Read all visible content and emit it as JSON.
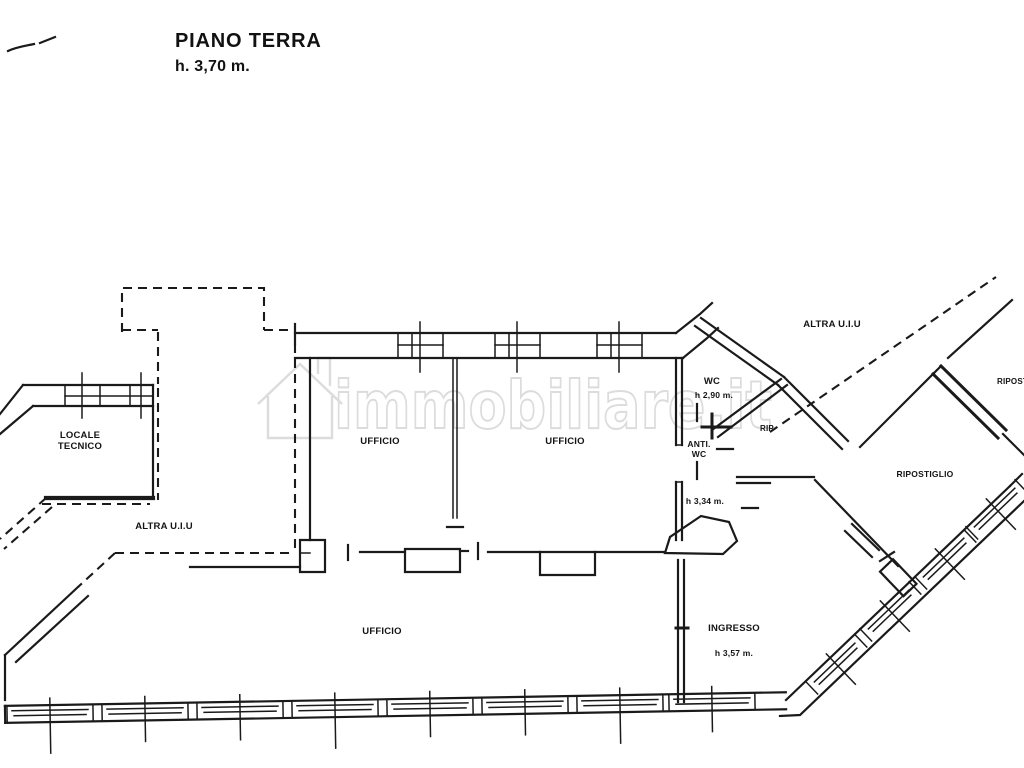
{
  "title": {
    "line1": "PIANO TERRA",
    "line2": "h. 3,70 m."
  },
  "watermark": {
    "text": "immobiliare.it",
    "icon": "house-icon"
  },
  "rooms": {
    "locale_tecnico": {
      "line1": "LOCALE",
      "line2": "TECNICO"
    },
    "altra_uiu_left": {
      "label": "ALTRA U.I.U"
    },
    "ufficio_top_left": {
      "label": "UFFICIO"
    },
    "ufficio_top_right": {
      "label": "UFFICIO"
    },
    "ufficio_main": {
      "label": "UFFICIO"
    },
    "wc": {
      "label": "WC",
      "height": "h 2,90 m."
    },
    "anti_wc": {
      "line1": "ANTI.",
      "line2": "WC",
      "height": "h 3,34 m."
    },
    "rip": {
      "label": "RIP"
    },
    "altra_uiu_right": {
      "label": "ALTRA U.I.U"
    },
    "ripostiglio": {
      "label": "RIPOSTIGLIO"
    },
    "ripostiglio_edge": {
      "label": "RIPOSTIGLIO"
    },
    "ingresso": {
      "label": "INGRESSO",
      "height": "h 3,57 m."
    }
  },
  "colors": {
    "ink": "#1a1a1a",
    "watermark": "#dcdcdc",
    "background": "#ffffff"
  }
}
